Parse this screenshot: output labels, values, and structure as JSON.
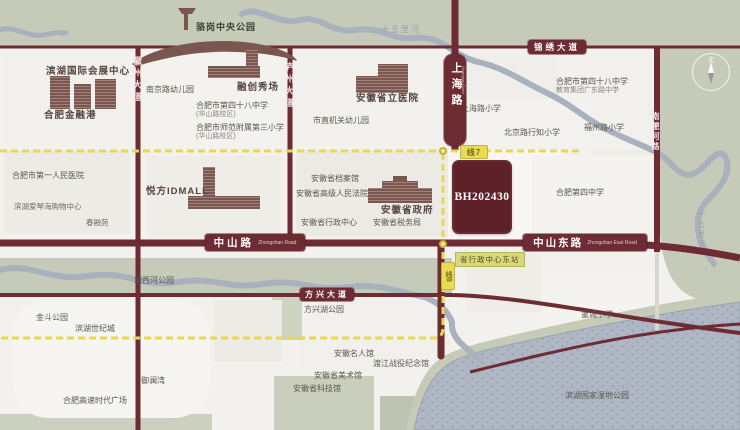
{
  "map": {
    "plot": {
      "code": "BH202430"
    },
    "roads": {
      "jinxiu": "锦绣大道",
      "zhongshan": "中山路",
      "zhongshan_en": "Zhongshan Road",
      "zhongshan_east": "中山东路",
      "zhongshan_east_en": "Zhongshan East Road",
      "fangxing": "方兴大道",
      "huizhou": "徽州大道",
      "luzhou": "庐州大道",
      "shanghai": "上海路",
      "shanghai_en": "Shanghai Road",
      "nanfeihe": "南淝河路"
    },
    "metro": {
      "line7_badge": "线7",
      "line8_badge": "线8",
      "station": "省行政中心东站"
    },
    "compass": {
      "north": "北"
    },
    "colors": {
      "road": "#6d2b33",
      "metro": "#e8d84f",
      "plot": "#5e2029",
      "park_band": "#c6cbb9",
      "water": "#afb7c4"
    },
    "pois": [
      {
        "label": "骆岗中央公园",
        "x": 196,
        "y": 22,
        "cls": "onband"
      },
      {
        "label": "滨湖国际会展中心",
        "x": 46,
        "y": 66,
        "cls": "lg"
      },
      {
        "label": "合肥金融港",
        "x": 44,
        "y": 110,
        "cls": "lg"
      },
      {
        "label": "南京路幼儿园",
        "type": "school",
        "x": 146,
        "y": 85
      },
      {
        "label": "融创秀场",
        "x": 237,
        "y": 82,
        "cls": "lg"
      },
      {
        "label": "合肥市第四十八中学",
        "label2": "(华山路校区)",
        "type": "school",
        "x": 196,
        "y": 101
      },
      {
        "label": "合肥市师范附属第三小学",
        "label2": "(华山路校区)",
        "type": "school",
        "x": 196,
        "y": 123
      },
      {
        "label": "合肥市第一人民医院",
        "type": "school",
        "x": 12,
        "y": 171
      },
      {
        "label": "滨湖爱琴海购物中心",
        "x": 14,
        "y": 202,
        "cls": "sm"
      },
      {
        "label": "春融苑",
        "x": 86,
        "y": 218,
        "cls": "sm"
      },
      {
        "label": "悦方IDMALL",
        "x": 146,
        "y": 186,
        "cls": "lg"
      },
      {
        "label": "安徽省立医院",
        "x": 356,
        "y": 93,
        "cls": "lg"
      },
      {
        "label": "市直机关幼儿园",
        "type": "school",
        "x": 313,
        "y": 116
      },
      {
        "label": "上海路小学",
        "type": "school",
        "x": 461,
        "y": 104
      },
      {
        "label": "合肥市第四十八中学",
        "label2": "教育集团广东路中学",
        "type": "school",
        "x": 556,
        "y": 77
      },
      {
        "label": "北京路行知小学",
        "type": "school",
        "x": 504,
        "y": 128
      },
      {
        "label": "福州路小学",
        "type": "school",
        "x": 584,
        "y": 123
      },
      {
        "label": "合肥第四中学",
        "type": "school",
        "x": 556,
        "y": 188
      },
      {
        "label": "安徽省档案馆",
        "type": "gov",
        "x": 311,
        "y": 174
      },
      {
        "label": "安徽省高级人民法院",
        "type": "gov",
        "x": 296,
        "y": 189
      },
      {
        "label": "安徽省政府",
        "x": 381,
        "y": 205,
        "cls": "lg"
      },
      {
        "label": "安徽省行政中心",
        "type": "gov",
        "x": 301,
        "y": 218
      },
      {
        "label": "安徽省税务局",
        "type": "gov",
        "x": 373,
        "y": 218
      },
      {
        "label": "塘西河公园",
        "type": "park",
        "x": 134,
        "y": 276
      },
      {
        "label": "金斗公园",
        "type": "park",
        "x": 36,
        "y": 313
      },
      {
        "label": "滨湖世纪城",
        "type": "res",
        "x": 75,
        "y": 324
      },
      {
        "label": "御澜湾",
        "type": "res",
        "x": 141,
        "y": 376
      },
      {
        "label": "合肥高速时代广场",
        "type": "res",
        "x": 63,
        "y": 396
      },
      {
        "label": "方兴湖公园",
        "type": "park",
        "x": 304,
        "y": 305
      },
      {
        "label": "安徽名人馆",
        "type": "gov",
        "x": 334,
        "y": 349
      },
      {
        "label": "渡江战役纪念馆",
        "type": "gov",
        "x": 373,
        "y": 359
      },
      {
        "label": "安徽省美术馆",
        "type": "gov",
        "x": 314,
        "y": 371
      },
      {
        "label": "安徽省科技馆",
        "type": "gov",
        "x": 293,
        "y": 384
      },
      {
        "label": "董城小学",
        "type": "school",
        "x": 581,
        "y": 310
      },
      {
        "label": "滨湖国家湿地公园",
        "type": "park",
        "x": 565,
        "y": 391
      },
      {
        "label": "十五里河",
        "x": 381,
        "y": 25,
        "cls": "water"
      },
      {
        "label": "十五里河",
        "x": 696,
        "y": 210,
        "cls": "water vert"
      }
    ]
  }
}
